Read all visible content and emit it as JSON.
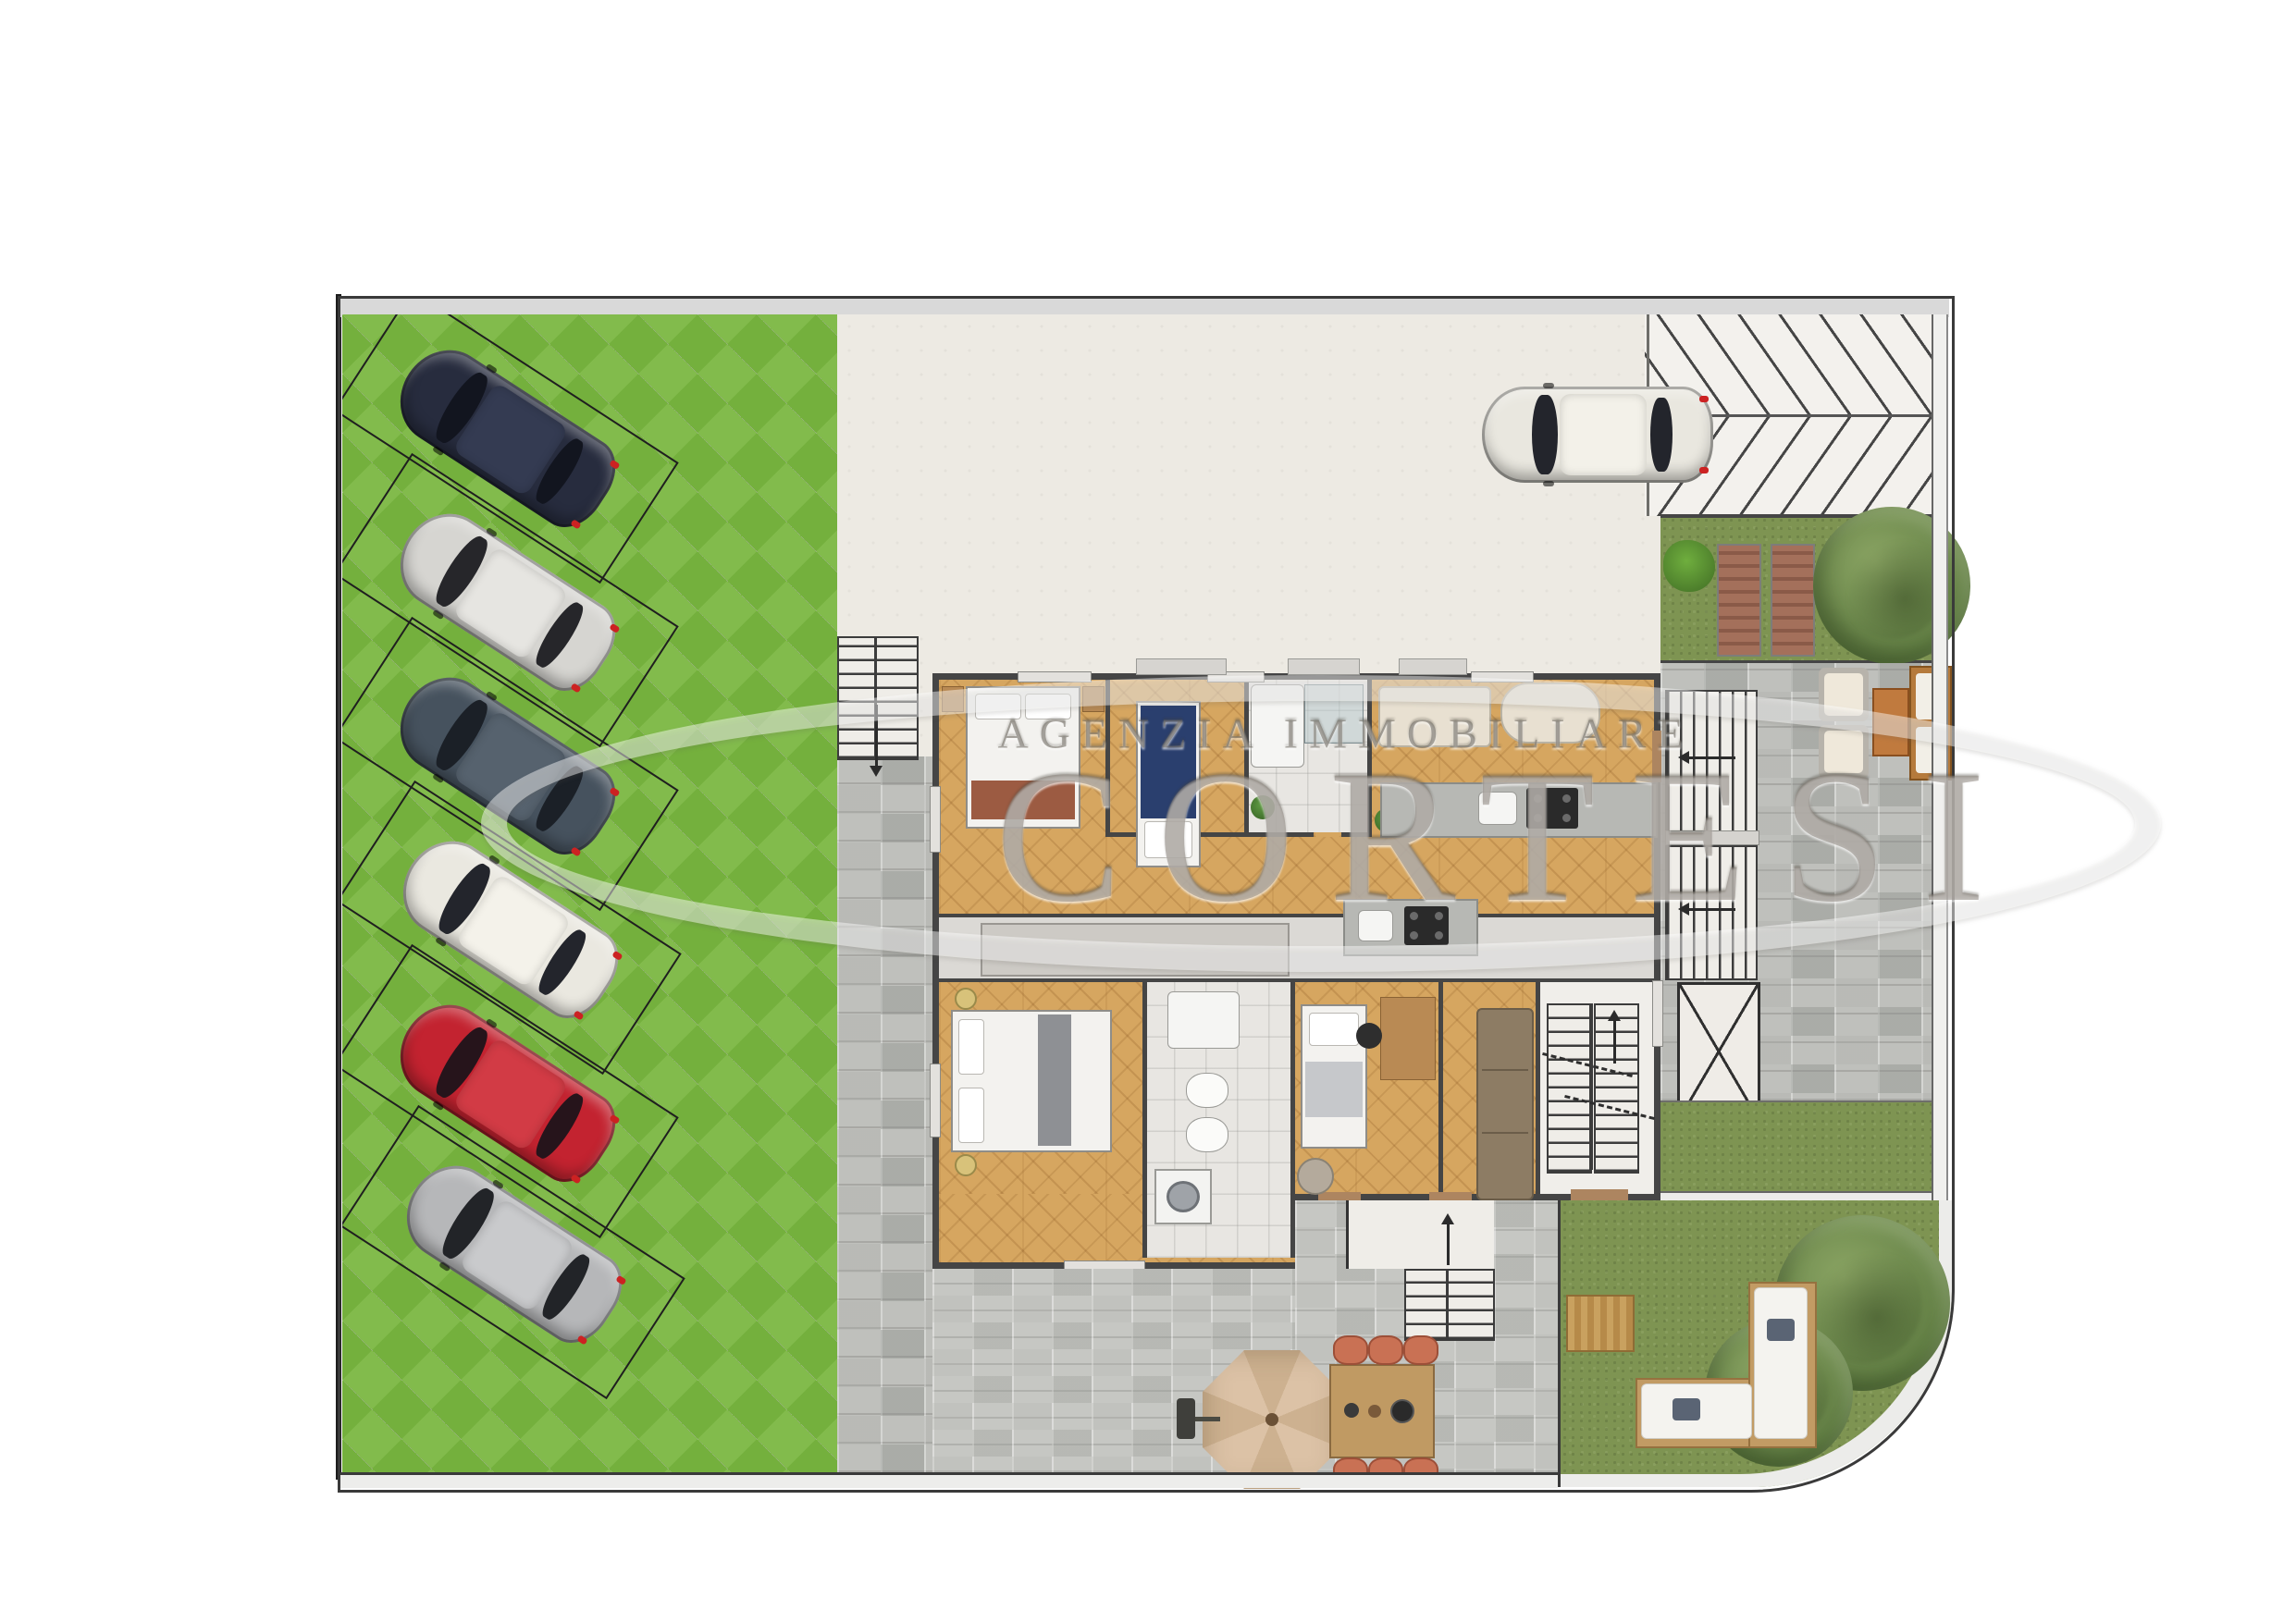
{
  "title": "Rendered ground-floor site plan with parking court, apartments, terraces and gardens",
  "watermark": {
    "agency_line": "AGENZIA IMMOBILIARE",
    "brand": "CORTESI"
  },
  "palette": {
    "road": "#d9d9d9",
    "paver_base": "#a9aca3",
    "paver_green": "#74b03d",
    "paver_green_alt": "#82bb4c",
    "courtyard": "#edeae3",
    "ramp": "#f3f1ed",
    "grass": "#7e9452",
    "stone": "#bfc0bc",
    "stone_light": "#c6c7c3",
    "parquet": "#d6a660",
    "bath_floor": "#e8e6e2",
    "corridor": "#dbd9d5",
    "wall": "#454545",
    "navy_bed": "#2a3f6e",
    "sofa_brown": "#8d7c64",
    "cream": "#efe8da"
  },
  "cars": [
    {
      "name": "dark-navy-suv",
      "body": "#272c3e",
      "roof": "#343b52",
      "glass": "#12151f"
    },
    {
      "name": "silver-sedan",
      "body": "#d6d5d1",
      "roof": "#e6e5e1",
      "glass": "#26262a"
    },
    {
      "name": "steel-blue-wagon",
      "body": "#46525e",
      "roof": "#56626e",
      "glass": "#1b2027"
    },
    {
      "name": "white-hatchback",
      "body": "#eae8e0",
      "roof": "#f4f2ea",
      "glass": "#23252c"
    },
    {
      "name": "red-sedan",
      "body": "#c32330",
      "roof": "#d23b45",
      "glass": "#26141b"
    },
    {
      "name": "gray-hatchback",
      "body": "#b6b7b9",
      "roof": "#c9cacc",
      "glass": "#222428"
    },
    {
      "name": "white-city-car-courtyard",
      "body": "#e9e7df",
      "roof": "#f3f1e9",
      "glass": "#23252c"
    },
    {
      "name": "white-city-car-drive",
      "body": "#e9e7df",
      "roof": "#f3f1e9",
      "glass": "#23252c"
    }
  ],
  "site": {
    "angled_parking_stalls": 6,
    "straight_parking_stalls": 2,
    "outdoor_areas": [
      "grass-grid paver parking court",
      "entrance courtyard",
      "hatched driveway ramp",
      "side garden with two sun loungers and trees",
      "stone terrace with armchair lounge set",
      "stone patio with dining table, six chairs and parasol",
      "private lawn with L-shaped outdoor sofa and trees"
    ]
  },
  "building": {
    "units": [
      {
        "name": "upper apartment",
        "rooms": [
          "double bedroom",
          "single bedroom",
          "bathroom with shower",
          "living-dining room",
          "kitchen counter"
        ]
      },
      {
        "name": "lower apartment",
        "rooms": [
          "double bedroom",
          "bathroom with laundry",
          "single bedroom with desk",
          "living room",
          "kitchenette",
          "stair hall"
        ]
      }
    ],
    "circulation": [
      "internal switchback stair with up arrow",
      "external side stair going down",
      "two external flights by the terrace",
      "cross-marked shaft / skylight",
      "patio steps with up arrow"
    ]
  }
}
